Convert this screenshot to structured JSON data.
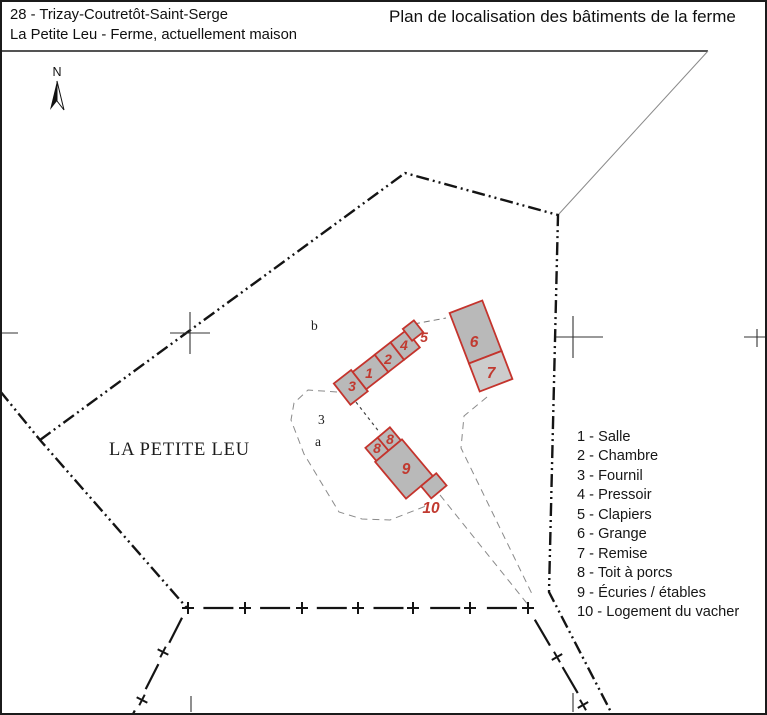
{
  "header": {
    "region_line": "28 - Trizay-Coutretôt-Saint-Serge",
    "site_line": "La Petite Leu - Ferme, actuellement maison",
    "title": "Plan de localisation des bâtiments de la ferme"
  },
  "map": {
    "place_label": "LA PETITE LEU",
    "north_label": "N",
    "parcel_labels": {
      "b": "b",
      "num3": "3",
      "a": "a"
    },
    "building_numbers": [
      "3",
      "1",
      "2",
      "4",
      "5",
      "6",
      "7",
      "8",
      "8",
      "9",
      "10"
    ],
    "colors": {
      "building_outline": "#c4342d",
      "building_fill": "#b9b9b9",
      "building_fill_light": "#cccccc",
      "number_red": "#c13a30",
      "boundary_black": "#141414",
      "track_gray": "#8a8a8a"
    }
  },
  "legend": {
    "items": [
      "1 - Salle",
      "2 - Chambre",
      "3 - Fournil",
      "4 - Pressoir",
      "5 - Clapiers",
      "6 - Grange",
      "7 - Remise",
      "8 - Toit à porcs",
      "9 - Écuries / étables",
      "10 - Logement du vacher"
    ]
  }
}
